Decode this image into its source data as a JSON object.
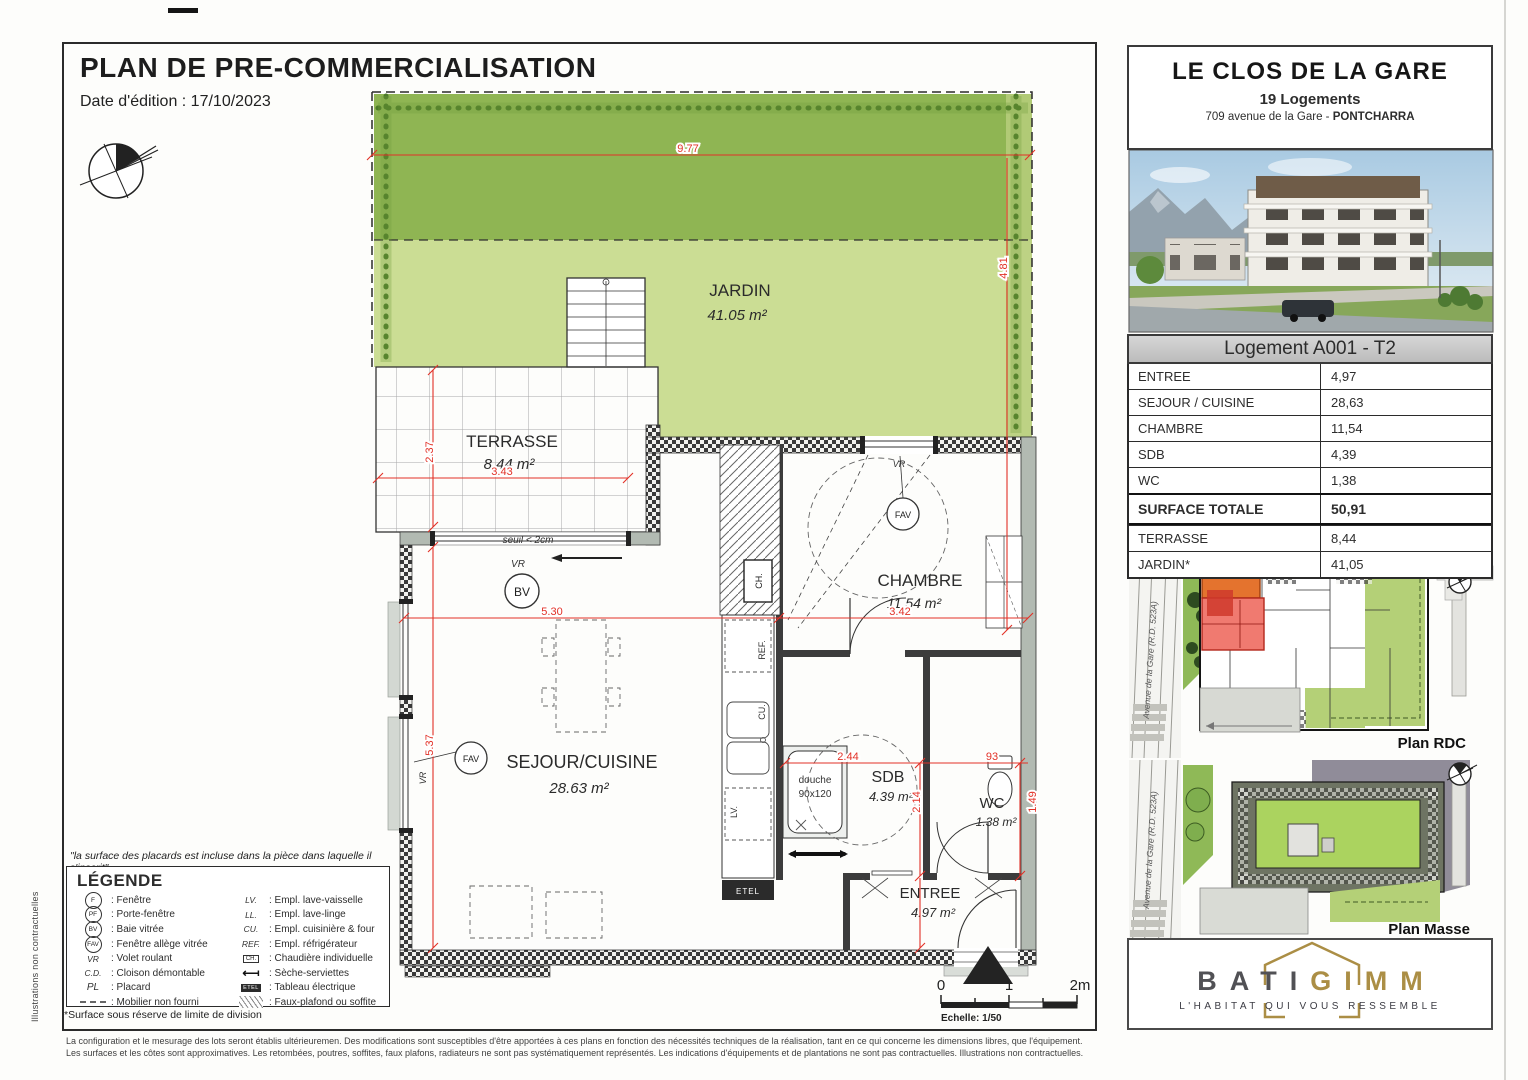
{
  "header": {
    "title": "PLAN DE PRE-COMMERCIALISATION",
    "date": "Date d'édition : 17/10/2023",
    "side_note": "Illustrations non contractuelles"
  },
  "plan": {
    "rooms": {
      "jardin": {
        "name": "JARDIN",
        "area": "41.05 m²"
      },
      "terrasse": {
        "name": "TERRASSE",
        "area": "8.44 m²"
      },
      "sejour": {
        "name": "SEJOUR/CUISINE",
        "area": "28.63 m²"
      },
      "chambre": {
        "name": "CHAMBRE",
        "area": "11.54 m²"
      },
      "sdb": {
        "name": "SDB",
        "area": "4.39 m²"
      },
      "wc": {
        "name": "WC",
        "area": "1.38 m²"
      },
      "entree": {
        "name": "ENTREE",
        "area": "4.97 m²"
      }
    },
    "annot": {
      "douche": "douche",
      "douche_size": "90x120",
      "seuil": "seuil < 2cm",
      "bv": "BV",
      "fav": "FAV",
      "vr": "VR",
      "ref": "REF.",
      "cu": "CU.",
      "lv": "LV.",
      "ll": "LL.",
      "ch": "CH.",
      "etel": "ETEL"
    },
    "dims": {
      "d1": "9.77",
      "d2": "4.81",
      "d3": "2.37",
      "d4": "3.43",
      "d5": "5.30",
      "d6": "3.42",
      "d7": "5.37",
      "d8": "2.44",
      "d9": "2.14",
      "d10": "93",
      "d11": "1.49"
    },
    "scale": {
      "z": "0",
      "o": "1",
      "t": "2m",
      "label": "Echelle: 1/50"
    }
  },
  "legend": {
    "quote": "\"la surface des placards est incluse dans la pièce dans laquelle il s'inscrit\"",
    "title": "LÉGENDE",
    "left": [
      {
        "sym": "F",
        "label": ": Fenêtre"
      },
      {
        "sym": "PF",
        "label": ": Porte-fenêtre"
      },
      {
        "sym": "BV",
        "label": ": Baie vitrée"
      },
      {
        "sym": "FAV",
        "label": ": Fenêtre allège vitrée"
      },
      {
        "sym": "VR",
        "label": ": Volet roulant"
      },
      {
        "sym": "C.D.",
        "label": ": Cloison démontable"
      },
      {
        "sym": "PL",
        "label": ": Placard"
      },
      {
        "sym": "",
        "label": ": Mobilier non fourni"
      }
    ],
    "right": [
      {
        "sym": "LV.",
        "label": ": Empl. lave-vaisselle"
      },
      {
        "sym": "LL.",
        "label": ": Empl. lave-linge"
      },
      {
        "sym": "CU.",
        "label": ": Empl. cuisinière & four"
      },
      {
        "sym": "REF.",
        "label": ": Empl. réfrigérateur"
      },
      {
        "sym": "CH.",
        "label": ": Chaudière individuelle"
      },
      {
        "sym": "",
        "label": ": Sèche-serviettes"
      },
      {
        "sym": "ETEL",
        "label": ": Tableau électrique"
      },
      {
        "sym": "",
        "label": ": Faux-plafond ou soffite"
      }
    ],
    "footnote": "*Surface sous réserve de limite de division"
  },
  "info": {
    "title": "LE CLOS DE LA GARE",
    "subtitle": "19 Logements",
    "address_pre": "709 avenue de la Gare - ",
    "city": "PONTCHARRA",
    "lot": "Logement A001 - T2",
    "rows": [
      {
        "label": "ENTREE",
        "value": "4,97"
      },
      {
        "label": "SEJOUR / CUISINE",
        "value": "28,63"
      },
      {
        "label": "CHAMBRE",
        "value": "11,54"
      },
      {
        "label": "SDB",
        "value": "4,39"
      },
      {
        "label": "WC",
        "value": "1,38"
      }
    ],
    "total": {
      "label": "SURFACE TOTALE",
      "value": "50,91"
    },
    "extras": [
      {
        "label": "TERRASSE",
        "value": "8,44"
      },
      {
        "label": "JARDIN*",
        "value": "41,05"
      }
    ],
    "street": "Avenue de la Gare (R.D. 523A)",
    "plan_rdc": "Plan RDC",
    "plan_masse": "Plan Masse",
    "logo": {
      "bati": "BATI",
      "gimm": "GIMM",
      "tagline": "L'HABITAT QUI VOUS RESSEMBLE"
    }
  },
  "footer": {
    "line1": "La configuration et le mesurage des lots seront établis ultérieuremen. Des modifications sont susceptibles d'être apportées à ces plans en fonction des nécessités techniques de la réalisation, tant en ce qui concerne les dimensions libres, que l'équipement.",
    "line2": "Les surfaces et les côtes sont approximatives. Les retombées, poutres, soffites, faux plafons, radiateurs ne sont pas systématiquement représentés. Les indications d'équipements et de plantations ne sont pas contractuelles. Illustrations non contractuelles."
  }
}
